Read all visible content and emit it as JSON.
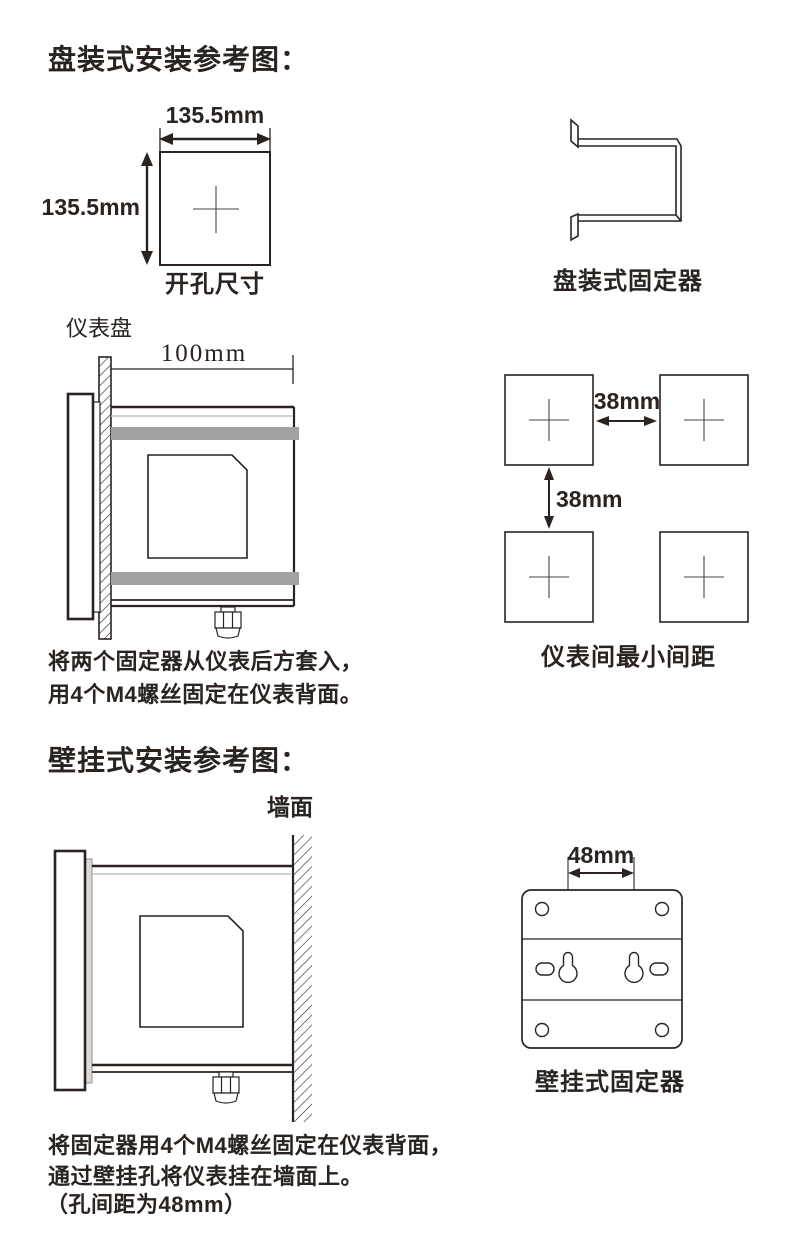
{
  "colors": {
    "ink": "#2a2320",
    "band_gray": "#a1a1a1",
    "light_gray": "#c3c0be"
  },
  "panel_mount": {
    "title": "盘装式安装参考图：",
    "cutout": {
      "width_label": "135.5mm",
      "height_label": "135.5mm",
      "caption": "开孔尺寸"
    },
    "fixer": {
      "caption": "盘装式固定器"
    },
    "side_view": {
      "panel_label": "仪表盘",
      "depth_label": "100mm"
    },
    "spacing": {
      "horizontal_label": "38mm",
      "vertical_label": "38mm",
      "caption": "仪表间最小间距"
    },
    "instructions": [
      "将两个固定器从仪表后方套入，",
      "用4个M4螺丝固定在仪表背面。"
    ]
  },
  "wall_mount": {
    "title": "壁挂式安装参考图：",
    "wall_label": "墙面",
    "fixer": {
      "hole_pitch_label": "48mm",
      "caption": "壁挂式固定器"
    },
    "instructions": [
      "将固定器用4个M4螺丝固定在仪表背面，",
      "通过壁挂孔将仪表挂在墙面上。",
      "（孔间距为48mm）"
    ]
  }
}
